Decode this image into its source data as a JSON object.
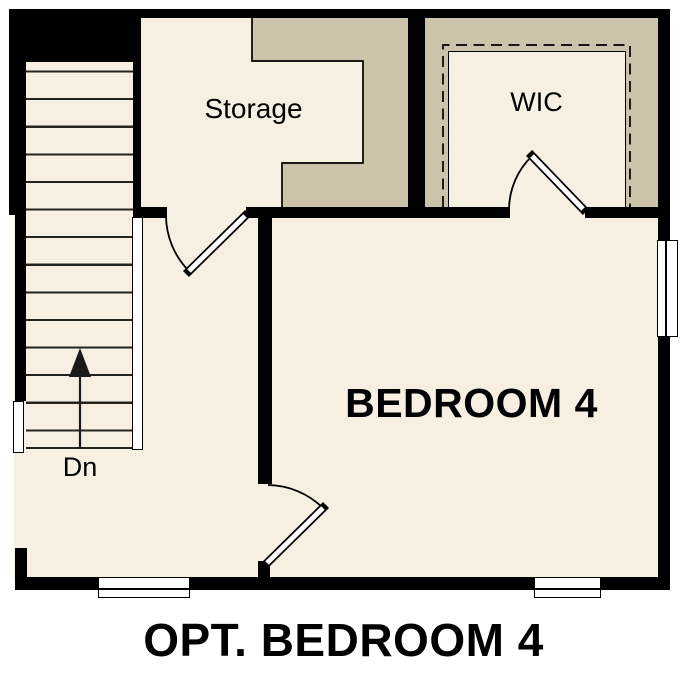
{
  "plan": {
    "caption": "OPT. BEDROOM 4",
    "rooms": {
      "storage": {
        "label": "Storage"
      },
      "wic": {
        "label": "WIC"
      },
      "bedroom": {
        "label": "BEDROOM 4"
      },
      "stairs": {
        "label": "Dn",
        "arrow_icon": "up-arrow"
      }
    },
    "colors": {
      "floor": "#f6efe2",
      "shaded_area": "#ccc3aa",
      "wall": "#000000",
      "background": "#ffffff"
    }
  }
}
